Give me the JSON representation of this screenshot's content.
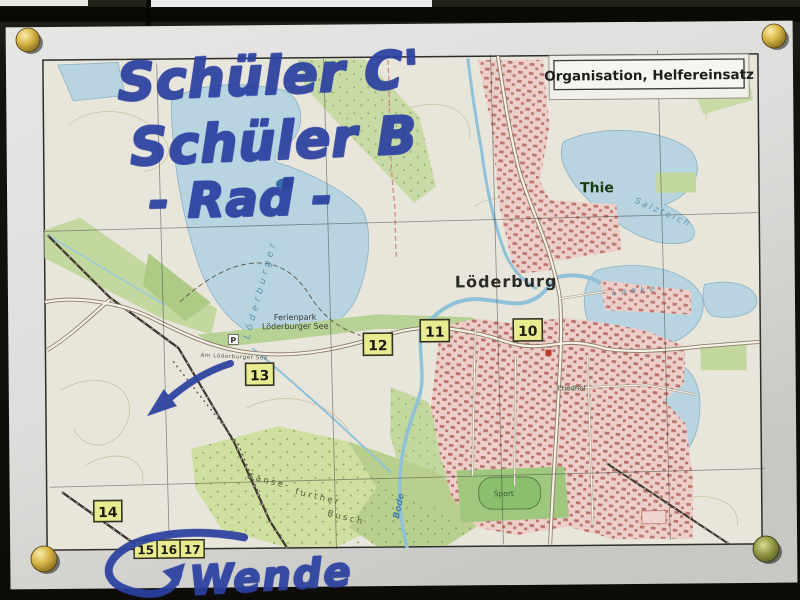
{
  "photo": {
    "handwriting": {
      "line1": "Schüler C'",
      "line2": "Schüler B",
      "line3": "- Rad -",
      "turnaround": "Wende"
    },
    "ink_color": "#2b3f9f"
  },
  "legend": {
    "title": "Organisation, Helfereinsatz"
  },
  "map": {
    "town_labels": {
      "loederburg": "Löderburg",
      "thie": "Thie"
    },
    "area_labels": {
      "ferienpark_line1": "Ferienpark",
      "ferienpark_line2": "Löderburger See",
      "gaense_line1": "Gänse-",
      "gaense_line2": "further",
      "gaense_line3": "Busch",
      "friedhof": "Friedhof",
      "sport": "Sport"
    },
    "water_labels": {
      "bode": "Bode",
      "loederburger_see": "Löderburger",
      "salzteich": "Salzteich",
      "laake": "Laake"
    },
    "street_labels": {
      "am_loederburger_see": "Am Löderburger See"
    },
    "symbols": {
      "parking": "P"
    },
    "markers": [
      {
        "label": "10"
      },
      {
        "label": "11"
      },
      {
        "label": "12"
      },
      {
        "label": "13"
      },
      {
        "label": "14"
      },
      {
        "label": "15"
      },
      {
        "label": "16"
      },
      {
        "label": "17"
      }
    ],
    "colors": {
      "water": "#b7d4e0",
      "forest": "#c8dba6",
      "settlement": "#eccfc9",
      "marker_box": "#e9eb90",
      "ink": "#2b3f9f"
    }
  }
}
